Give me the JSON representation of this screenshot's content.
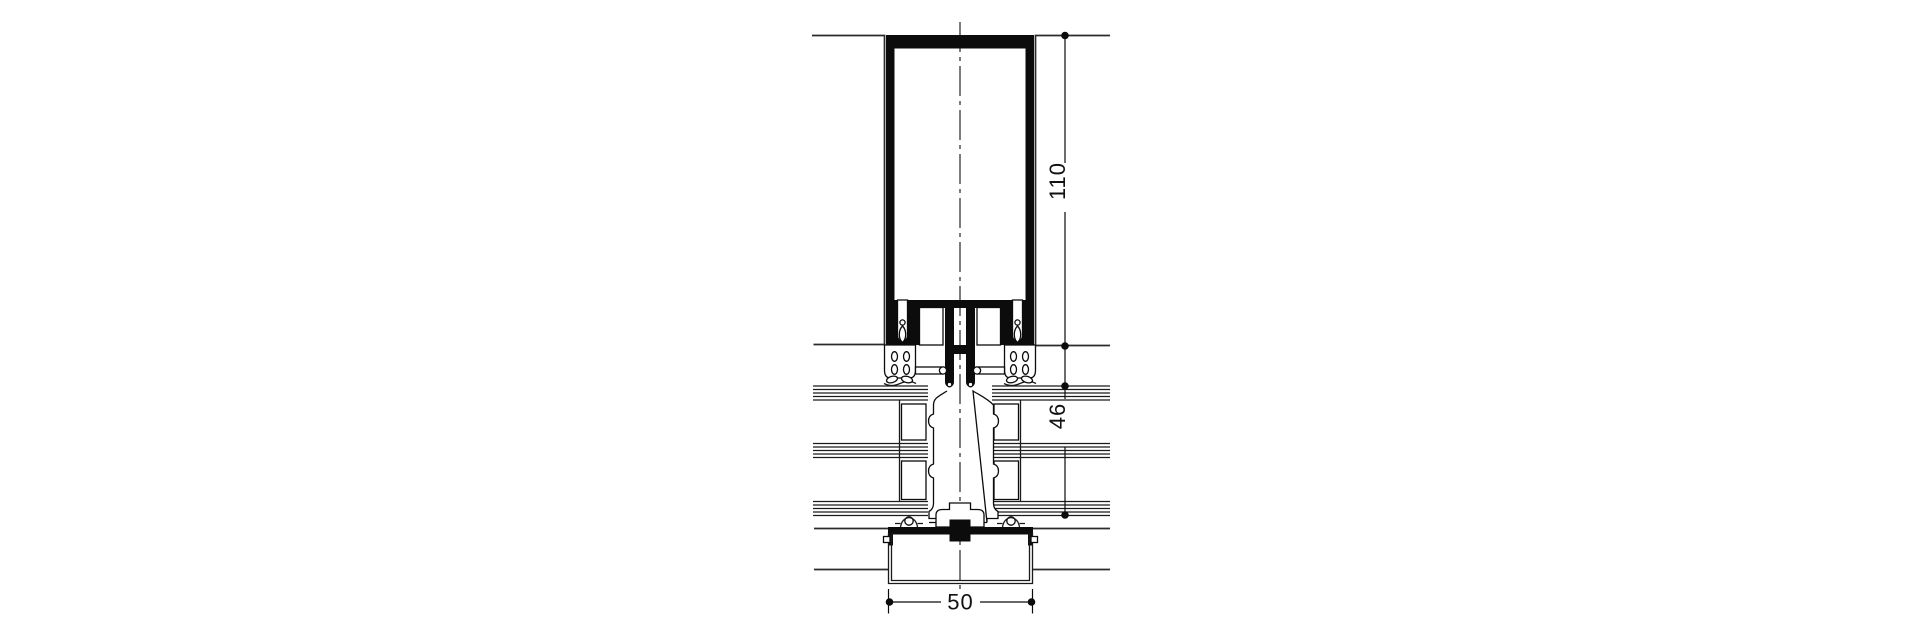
{
  "page": {
    "background": "#ffffff",
    "line_color": "#0c0c0c"
  },
  "drawing": {
    "type": "curtain-wall-mullion-section",
    "dimensions": {
      "d110": {
        "label": "110",
        "orientation": "vertical"
      },
      "d46": {
        "label": "46",
        "orientation": "vertical"
      },
      "d50": {
        "label": "50",
        "orientation": "horizontal"
      }
    }
  }
}
